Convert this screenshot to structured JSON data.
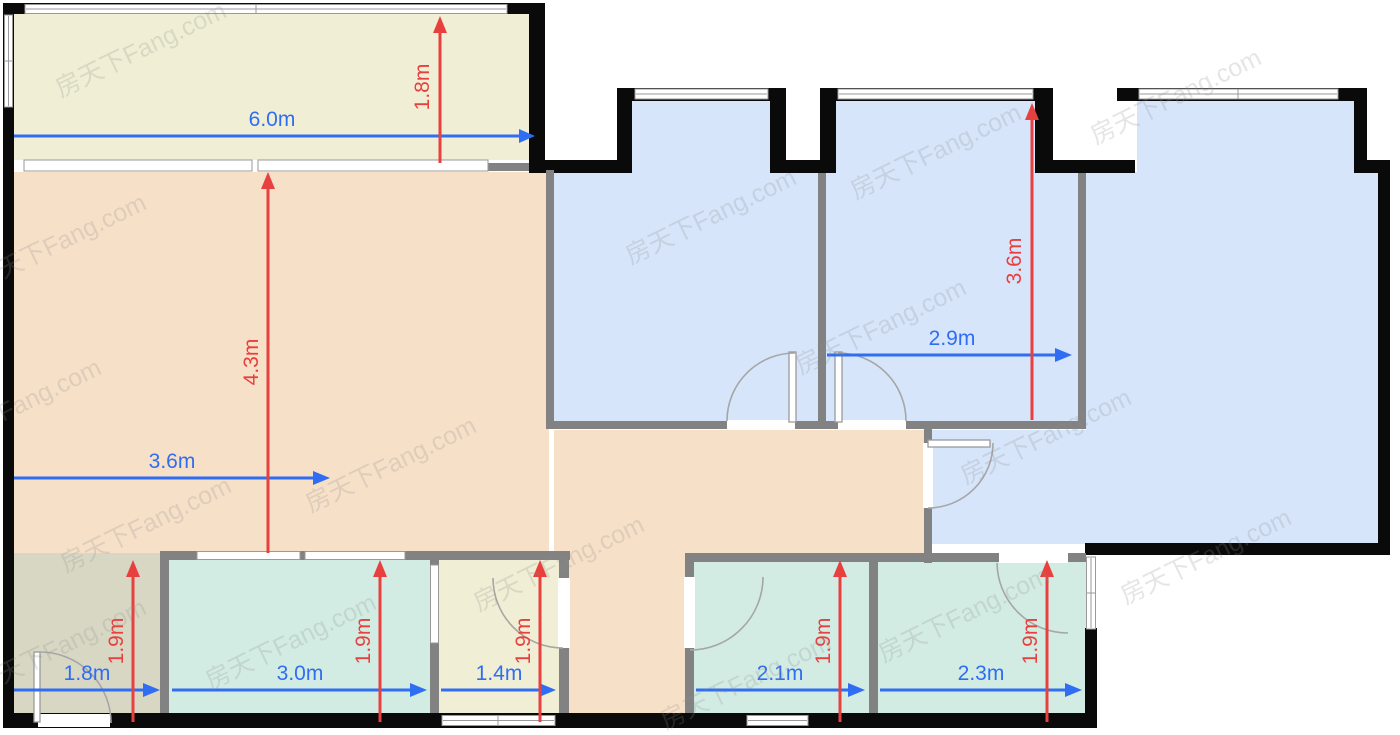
{
  "watermark": {
    "text": "房天下Fang.com"
  },
  "colors": {
    "dimension_blue": "#2f6df2",
    "dimension_red": "#e8403f",
    "wall_exterior": "#0a0a0a",
    "wall_interior": "#828282",
    "room_balcony": "#f0efd5",
    "room_living": "#f6e0c8",
    "room_bedroom_blue": "#d6e5fa",
    "room_teal": "#d2ece3",
    "room_bath_yellow": "#f0eed4",
    "room_entry_olive": "#d8d7c4"
  },
  "dimensions": {
    "balcony": {
      "width": "6.0m",
      "depth": "1.8m"
    },
    "living": {
      "width": "3.6m",
      "length": "4.3m"
    },
    "middle_bedroom": {
      "width": "2.9m",
      "depth": "3.6m"
    },
    "entry": {
      "width": "1.8m",
      "depth": "1.9m"
    },
    "kitchen": {
      "width": "3.0m",
      "depth": "1.9m"
    },
    "bath": {
      "width": "1.4m",
      "depth": "1.9m"
    },
    "small_room_left": {
      "width": "2.1m",
      "depth": "1.9m"
    },
    "small_room_right": {
      "width": "2.3m",
      "depth": "1.9m"
    }
  }
}
